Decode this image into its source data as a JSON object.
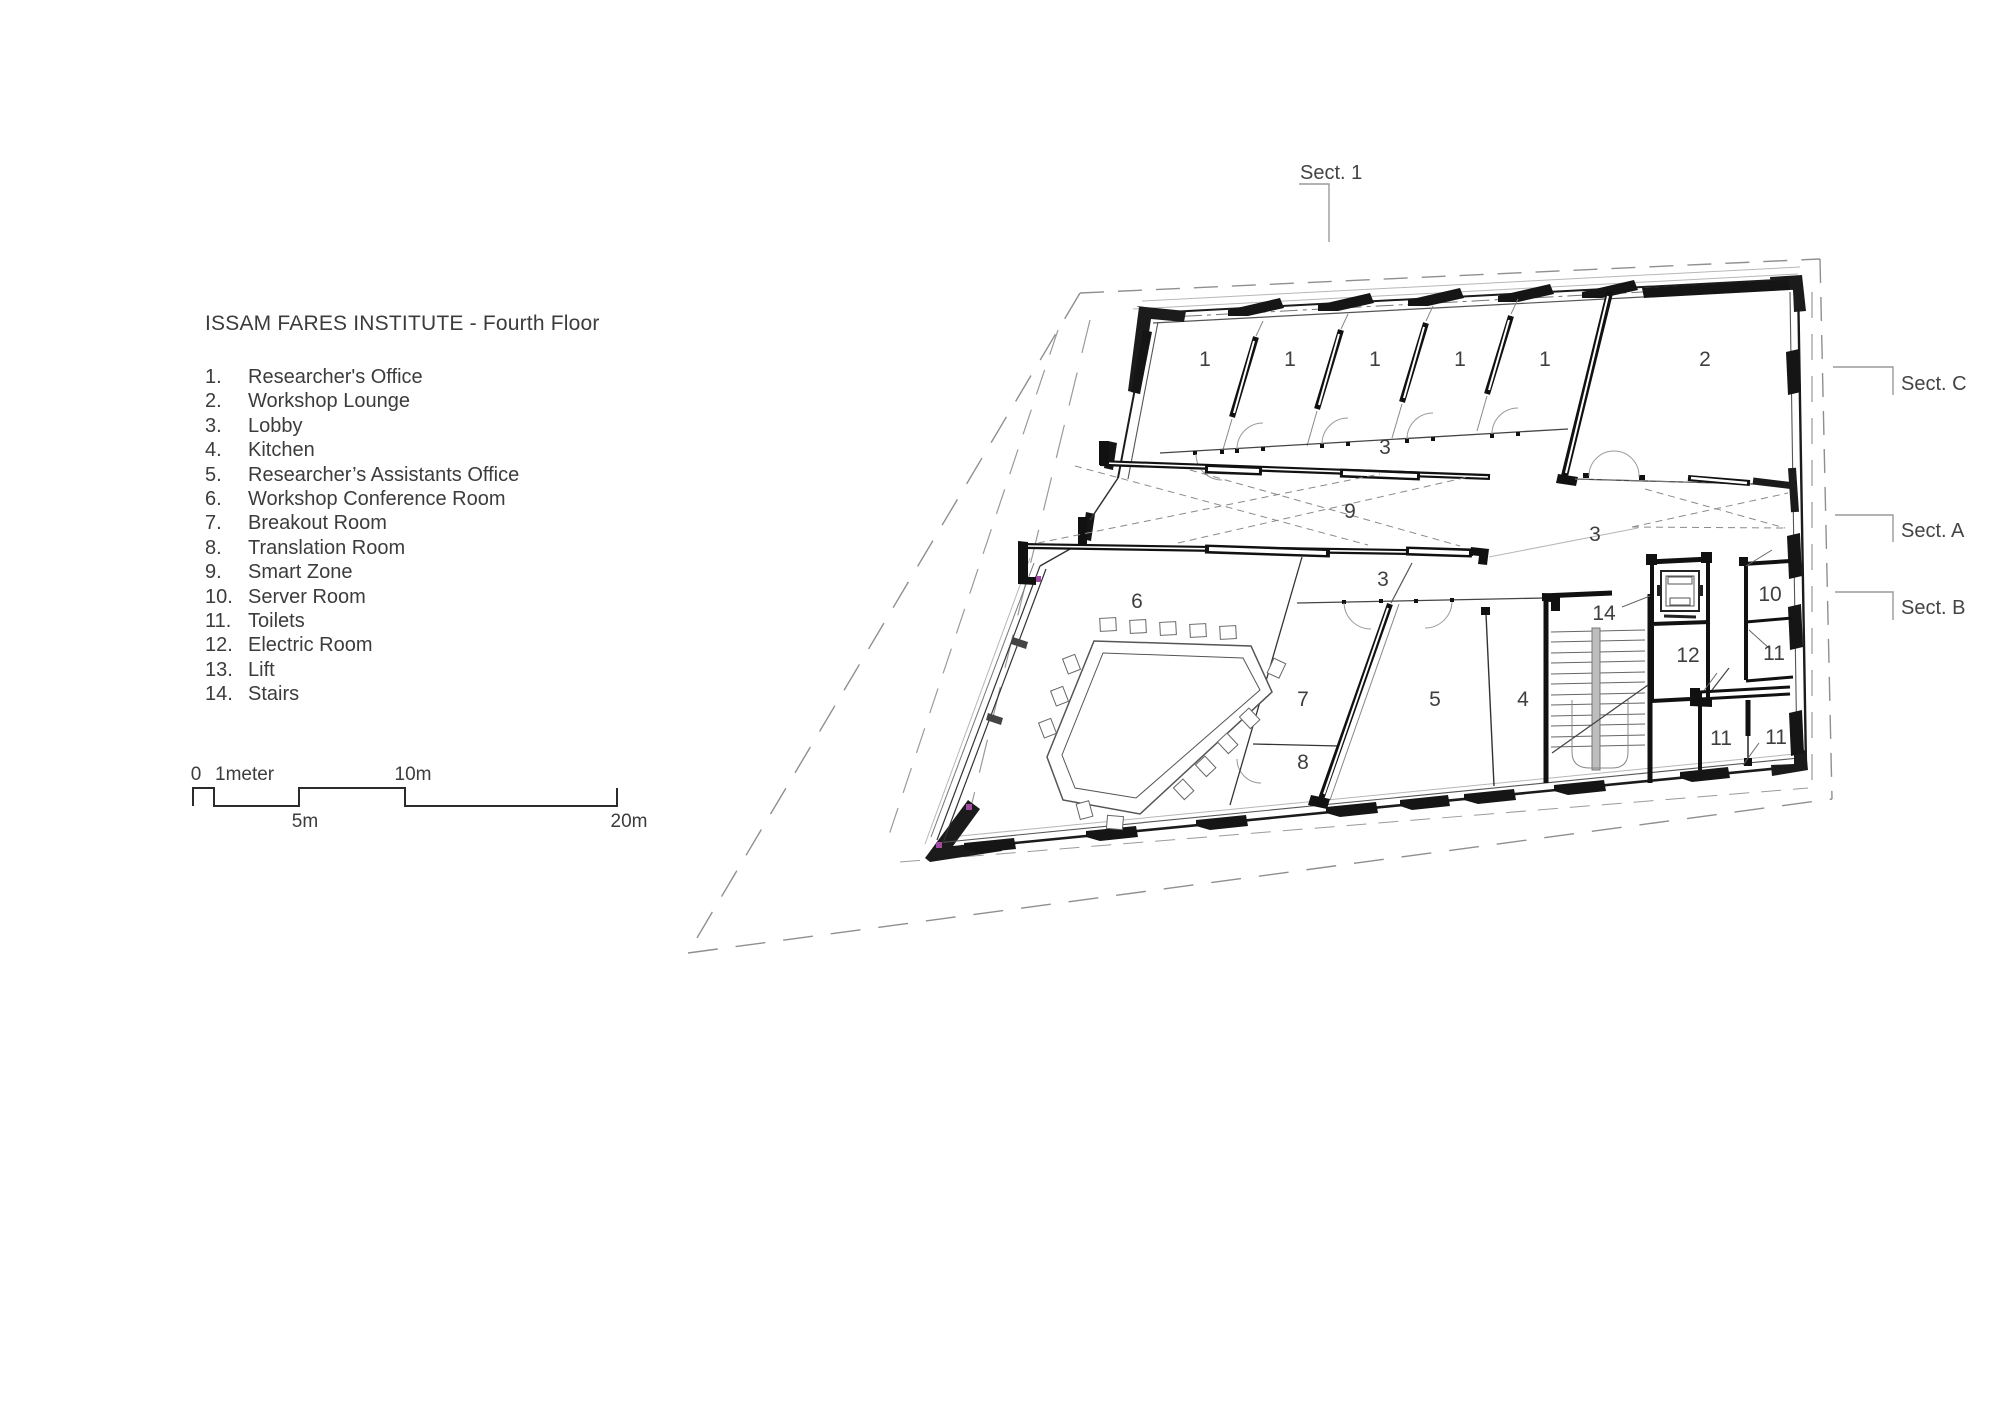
{
  "legend": {
    "title": "ISSAM FARES INSTITUTE - Fourth Floor",
    "items": [
      {
        "num": "1.",
        "label": "Researcher's Office"
      },
      {
        "num": "2.",
        "label": "Workshop Lounge"
      },
      {
        "num": "3.",
        "label": "Lobby"
      },
      {
        "num": "4.",
        "label": "Kitchen"
      },
      {
        "num": "5.",
        "label": "Researcher’s Assistants Office"
      },
      {
        "num": "6.",
        "label": "Workshop Conference Room"
      },
      {
        "num": "7.",
        "label": "Breakout Room"
      },
      {
        "num": "8.",
        "label": "Translation Room"
      },
      {
        "num": "9.",
        "label": "Smart Zone"
      },
      {
        "num": "10.",
        "label": "Server Room"
      },
      {
        "num": "11.",
        "label": "Toilets"
      },
      {
        "num": "12.",
        "label": "Electric Room"
      },
      {
        "num": "13.",
        "label": "Lift"
      },
      {
        "num": "14.",
        "label": "Stairs"
      }
    ]
  },
  "scale_bar": {
    "zero": "0",
    "one_meter": "1meter",
    "five": "5m",
    "ten": "10m",
    "twenty": "20m"
  },
  "sections": {
    "s1": "Sect. 1",
    "sc": "Sect. C",
    "sa": "Sect. A",
    "sb": "Sect. B"
  },
  "plan": {
    "room_labels": [
      {
        "id": "researchers-office-1",
        "text": "1"
      },
      {
        "id": "researchers-office-2",
        "text": "1"
      },
      {
        "id": "researchers-office-3",
        "text": "1"
      },
      {
        "id": "researchers-office-4",
        "text": "1"
      },
      {
        "id": "researchers-office-5",
        "text": "1"
      },
      {
        "id": "workshop-lounge",
        "text": "2"
      },
      {
        "id": "lobby-corridor",
        "text": "3"
      },
      {
        "id": "smart-zone",
        "text": "9"
      },
      {
        "id": "lobby-east",
        "text": "3"
      },
      {
        "id": "lobby-south",
        "text": "3"
      },
      {
        "id": "workshop-conference",
        "text": "6"
      },
      {
        "id": "breakout-room",
        "text": "7"
      },
      {
        "id": "translation-room",
        "text": "8"
      },
      {
        "id": "assistants-office",
        "text": "5"
      },
      {
        "id": "kitchen",
        "text": "4"
      },
      {
        "id": "stairs",
        "text": "14"
      },
      {
        "id": "electric-room",
        "text": "12"
      },
      {
        "id": "server-room",
        "text": "10"
      },
      {
        "id": "toilet-east",
        "text": "11"
      },
      {
        "id": "toilet-sw",
        "text": "11"
      },
      {
        "id": "toilet-se",
        "text": "11"
      }
    ]
  }
}
